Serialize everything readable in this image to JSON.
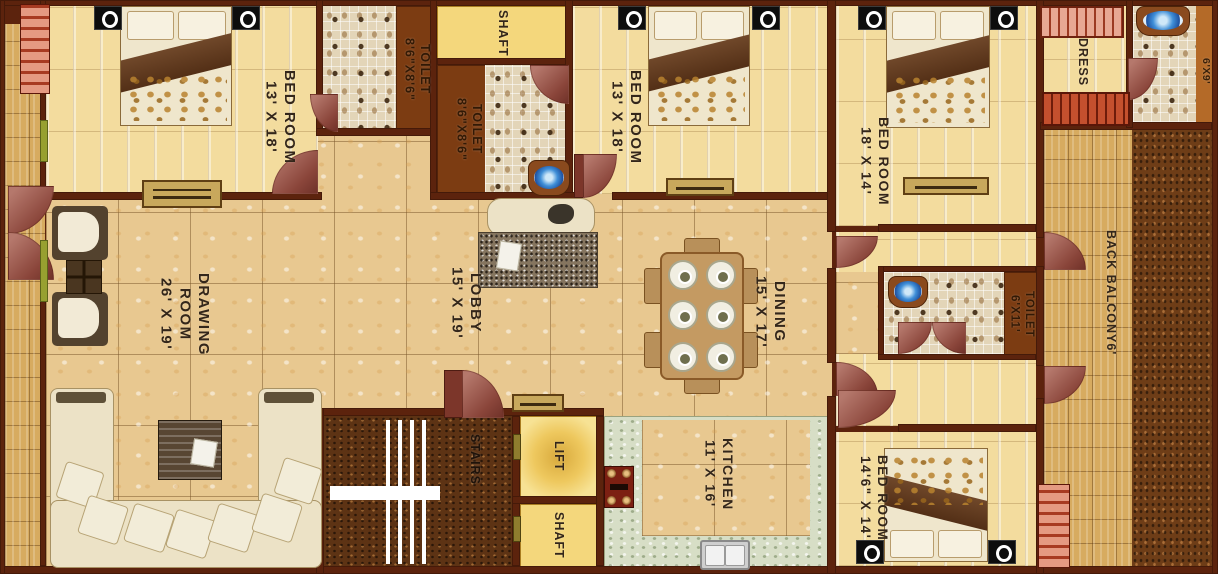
{
  "plan_type": "apartment-floor-plan",
  "rooms": [
    {
      "id": "bedroom-1",
      "lines": [
        "BED ROOM",
        "13' X 18'"
      ]
    },
    {
      "id": "toilet-1",
      "lines": [
        "TOILET",
        "8'6\"X8'6\""
      ]
    },
    {
      "id": "shaft-top",
      "lines": [
        "SHAFT"
      ]
    },
    {
      "id": "toilet-2",
      "lines": [
        "TOILET",
        "8'6\"X8'6\""
      ]
    },
    {
      "id": "bedroom-2",
      "lines": [
        "BED ROOM",
        "13' X 18'"
      ]
    },
    {
      "id": "bedroom-3",
      "lines": [
        "BED ROOM",
        "18' X 14'"
      ]
    },
    {
      "id": "dress",
      "lines": [
        "DRESS"
      ]
    },
    {
      "id": "toilet-3-partial",
      "lines": [
        "6'X9'"
      ]
    },
    {
      "id": "drawing-room",
      "lines": [
        "DRAWING",
        "ROOM",
        "26' X 19'"
      ]
    },
    {
      "id": "lobby",
      "lines": [
        "LOBBY",
        "15' X 19'"
      ]
    },
    {
      "id": "dining",
      "lines": [
        "DINING",
        "15' X 17'"
      ]
    },
    {
      "id": "toilet-4",
      "lines": [
        "TOILET",
        "6'X11'"
      ]
    },
    {
      "id": "back-balcony",
      "lines": [
        "BACK BALCONY6'"
      ]
    },
    {
      "id": "stairs",
      "lines": [
        "STAIRS"
      ]
    },
    {
      "id": "lift",
      "lines": [
        "LIFT"
      ]
    },
    {
      "id": "shaft-bottom",
      "lines": [
        "SHAFT"
      ]
    },
    {
      "id": "kitchen",
      "lines": [
        "KITCHEN",
        "11' X 16'"
      ]
    },
    {
      "id": "bedroom-4",
      "lines": [
        "BED ROOM",
        "14'6\" X 14'"
      ]
    }
  ],
  "furniture_icons": [
    "bed",
    "pillow",
    "wardrobe",
    "sofa",
    "cushion",
    "armchair",
    "coffee-table",
    "tv-unit",
    "dining-table",
    "plate",
    "stove",
    "kitchen-sink",
    "washbasin",
    "rug",
    "nightstand-lamp",
    "staircase",
    "door-swing"
  ],
  "colors": {
    "wall": "#5c230d",
    "plank_floor": "#f3dc9e",
    "marble_floor": "#e8c890",
    "mosaic_floor": "#e3d5b8",
    "parquet_balcony": "#d7ab60",
    "shaft_yellow": "#f4d77c",
    "door_maroon": "#8a453a",
    "stairs_carpet": "#5d3314",
    "wardrobe_salmon": "#e8a893",
    "wardrobe_red": "#c4502e",
    "washbasin_blue": "#3f8fd8",
    "label_text": "#33261a"
  }
}
